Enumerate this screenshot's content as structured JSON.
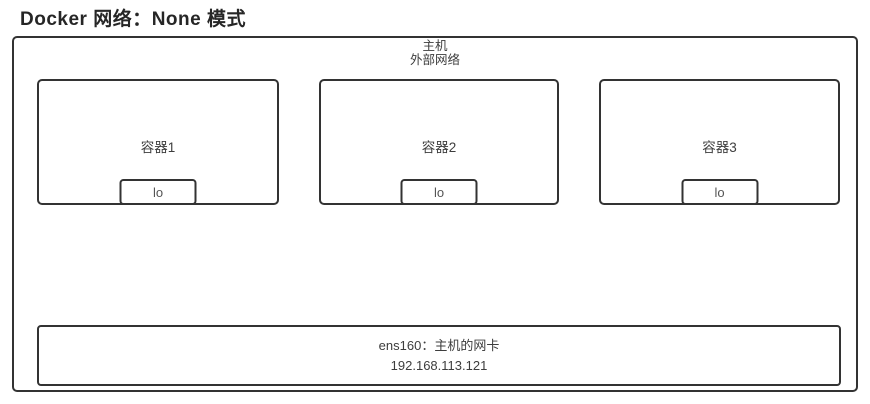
{
  "page": {
    "title": "Docker 网络：None 模式"
  },
  "host": {
    "label_line1": "主机",
    "label_line2": "外部网络"
  },
  "containers": [
    {
      "label": "容器1",
      "interface": "lo"
    },
    {
      "label": "容器2",
      "interface": "lo"
    },
    {
      "label": "容器3",
      "interface": "lo"
    }
  ],
  "nic": {
    "name": "ens160：主机的网卡",
    "ip": "192.168.113.121"
  },
  "colors": {
    "border": "#333333",
    "text": "#3d3d3d",
    "title": "#262626",
    "background": "#ffffff"
  }
}
